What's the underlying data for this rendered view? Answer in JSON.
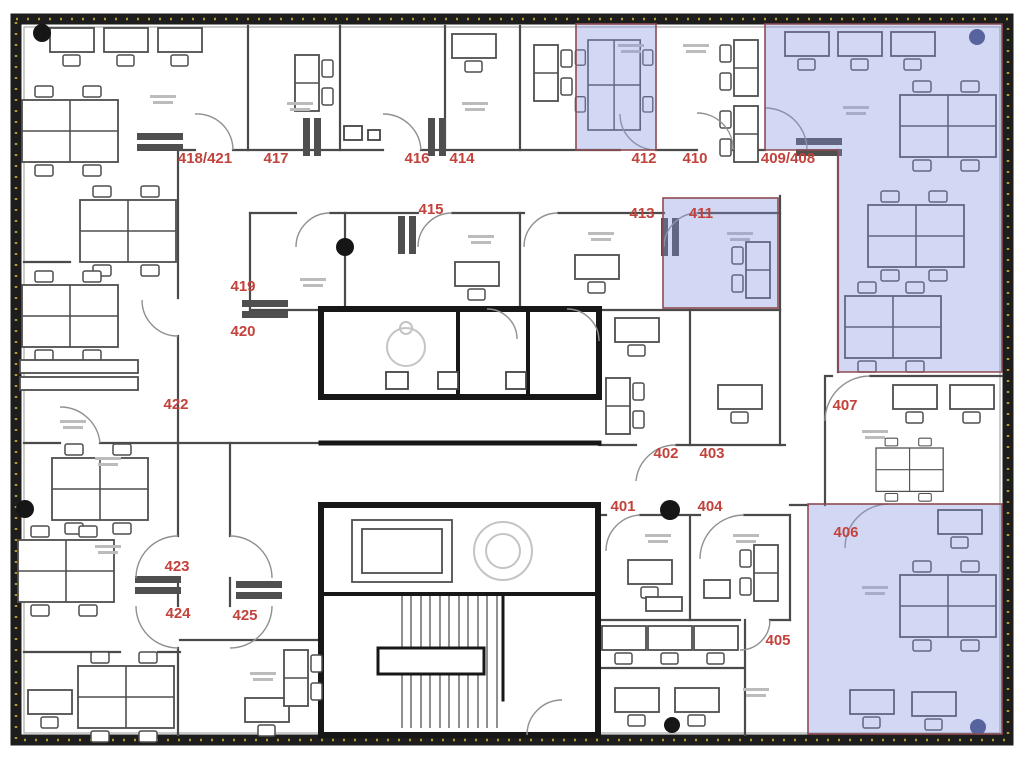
{
  "plan": {
    "type": "office-floor-plan",
    "rooms": [
      {
        "id": "418_421",
        "label": "418/421"
      },
      {
        "id": "417",
        "label": "417"
      },
      {
        "id": "416",
        "label": "416"
      },
      {
        "id": "414",
        "label": "414"
      },
      {
        "id": "412",
        "label": "412"
      },
      {
        "id": "410",
        "label": "410"
      },
      {
        "id": "409_408",
        "label": "409/408"
      },
      {
        "id": "415",
        "label": "415"
      },
      {
        "id": "413",
        "label": "413"
      },
      {
        "id": "411",
        "label": "411"
      },
      {
        "id": "419",
        "label": "419"
      },
      {
        "id": "420",
        "label": "420"
      },
      {
        "id": "422",
        "label": "422"
      },
      {
        "id": "402",
        "label": "402"
      },
      {
        "id": "403",
        "label": "403"
      },
      {
        "id": "407",
        "label": "407"
      },
      {
        "id": "401",
        "label": "401"
      },
      {
        "id": "404",
        "label": "404"
      },
      {
        "id": "406",
        "label": "406"
      },
      {
        "id": "423",
        "label": "423"
      },
      {
        "id": "424",
        "label": "424"
      },
      {
        "id": "425",
        "label": "425"
      },
      {
        "id": "405",
        "label": "405"
      }
    ],
    "highlighted_room_ids": [
      "412",
      "411",
      "409/408",
      "406"
    ],
    "colors": {
      "room_label_red": "#c2423c",
      "highlight_fill": "#8193dd",
      "highlight_border": "#8f4a52",
      "wall_gray": "#4a4a4a",
      "core_black": "#171717",
      "window_tick_yellow": "#b09a34",
      "column_navy": "#3d4977"
    }
  }
}
